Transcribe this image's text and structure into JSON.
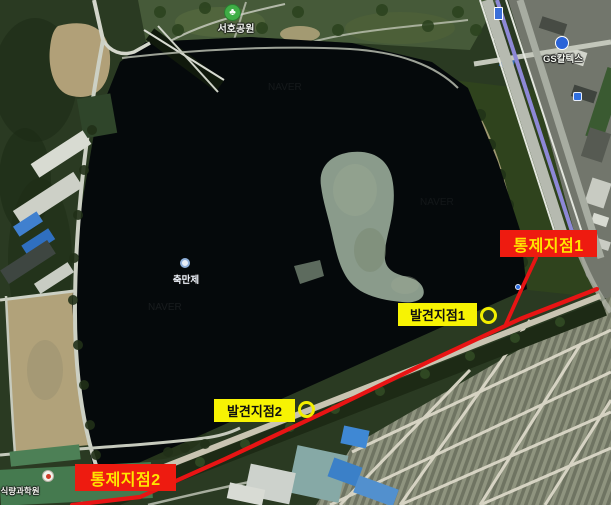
{
  "map": {
    "watermark": "NAVER",
    "pois": {
      "park": {
        "label": "서호공원",
        "icon_glyph": "♣"
      },
      "lake": {
        "label": "축만제"
      },
      "gas_station": {
        "label": "GS칼텍스"
      },
      "institute": {
        "label": "식량과학원"
      }
    }
  },
  "annotations": {
    "control_point_1": {
      "label": "통제지점1"
    },
    "control_point_2": {
      "label": "통제지점2"
    },
    "discovery_point_1": {
      "label": "발견지점1"
    },
    "discovery_point_2": {
      "label": "발견지점2"
    },
    "colors": {
      "control_box_bg": "#ee1b10",
      "control_box_text": "#ffe400",
      "discovery_box_bg": "#f7f303",
      "discovery_box_text": "#101010",
      "route_line": "#e81414",
      "marker_circle": "#f2ee00"
    }
  }
}
